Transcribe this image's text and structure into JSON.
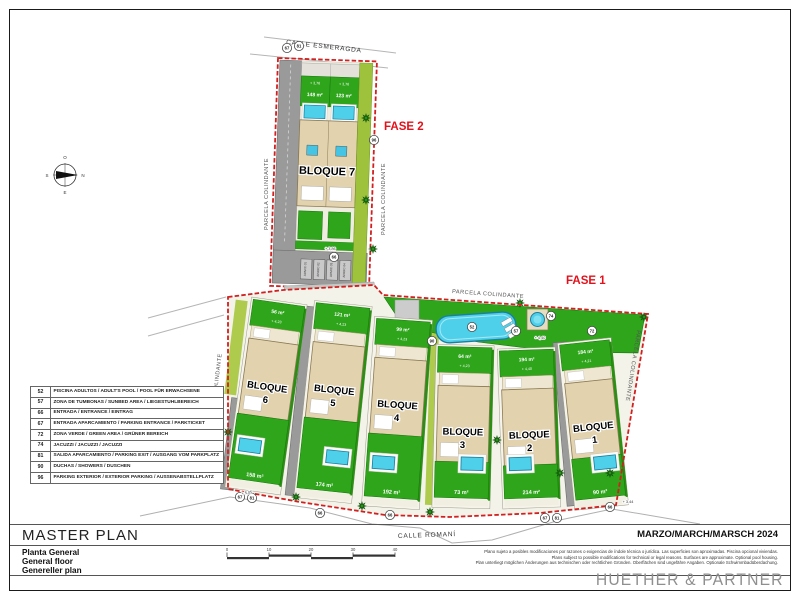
{
  "sheet": {
    "title": "MASTER PLAN",
    "subtitles": [
      "Planta General",
      "General floor",
      "Genereller plan"
    ],
    "date": "MARZO/MARCH/MARSCH 2024",
    "firm": "HUETHER & PARTNER",
    "disclaimer": [
      "Plano sujeto a posibles modificaciones por razones o exigencias de índole técnica o jurídica. Las superficies son aproximadas. Piscina opcional viviendas.",
      "Plans subject to possible modifications for technical or legal reasons. Surfaces are approximate. Optional pool housing.",
      "Plan unterliegt möglichen Änderungen aus technischen oder rechtlichen Gründen. Oberflächen sind ungefähre Angaben. Optionale Schwimmbadüberdachung."
    ],
    "scale_ticks": [
      "0",
      "10",
      "20",
      "30",
      "40"
    ]
  },
  "streets": {
    "top": "CALLE ESMERAGDA",
    "bottom": "CALLE ROMANÍ"
  },
  "phases": {
    "fase1": "FASE 1",
    "fase2": "FASE 2"
  },
  "labels": {
    "parcela_colindante": "PARCELA COLINDANTE"
  },
  "compass": {
    "top": "O",
    "right": "N",
    "bottom": "E",
    "left": "S"
  },
  "fase2_block": {
    "name": "BLOQUE 7",
    "garden_areas": [
      "148 m²",
      "123 m²"
    ],
    "garden_levels": [
      "+ 3,76",
      "+ 3,76"
    ],
    "parking_level": "+ 3,86",
    "stalls": [
      "APARC 01",
      "APARC 02",
      "APARC 03",
      "APARC 04"
    ]
  },
  "blocks": [
    {
      "label": "BLOQUE",
      "number": "6",
      "front_area": "56 m²",
      "level": "+ 4,23",
      "rear_area": "158 m²"
    },
    {
      "label": "BLOQUE",
      "number": "5",
      "front_area": "121 m²",
      "level": "+ 4,23",
      "rear_area": "174 m²"
    },
    {
      "label": "BLOQUE",
      "number": "4",
      "front_area": "99 m²",
      "level": "+ 4,23",
      "rear_area": "192 m²"
    },
    {
      "label": "BLOQUE",
      "number": "3",
      "front_area": "64 m²",
      "level": "+ 4,23",
      "rear_area": "73 m²"
    },
    {
      "label": "BLOQUE",
      "number": "2",
      "front_area": "194 m²",
      "level": "+ 4,40",
      "rear_area": "214 m²"
    },
    {
      "label": "BLOQUE",
      "number": "1",
      "front_area": "184 m²",
      "level": "+ 4,21",
      "rear_area": "90 m²"
    }
  ],
  "levels_misc": [
    "+ 4,40",
    "+ 3,44",
    "+ 5,05"
  ],
  "legend": {
    "rows": [
      {
        "code": "52",
        "desc": "PISCINA ADULTOS / ADULT'S POOL / POOL FÜR ERWACHSENE"
      },
      {
        "code": "57",
        "desc": "ZONA DE TUMBONAS / SUNBED AREA / LIEGESTUHLBEREICH"
      },
      {
        "code": "66",
        "desc": "ENTRADA / ENTRANCE / EINTRAG"
      },
      {
        "code": "67",
        "desc": "ENTRADA APARCAMIENTO / PARKING ENTRANCE / PARKTICKET"
      },
      {
        "code": "72",
        "desc": "ZONA VERDE / GREEN AREA / GRÜNER BEREICH"
      },
      {
        "code": "74",
        "desc": "JACUZZI / JACUZZI / JACUZZI"
      },
      {
        "code": "81",
        "desc": "SALIDA APARCAMIENTO / PARKING EXIT / AUSGANG VOM PARKPLATZ"
      },
      {
        "code": "90",
        "desc": "DUCHAS / SHOWERS / DUSCHEN"
      },
      {
        "code": "96",
        "desc": "PARKING EXTERIOR / EXTERIOR PARKING / AUSSENABSTELLPLATZ"
      }
    ]
  },
  "markers": [
    "67",
    "81",
    "96",
    "66",
    "52",
    "90",
    "57",
    "74",
    "72",
    "67",
    "81",
    "66",
    "66",
    "67",
    "81",
    "66"
  ],
  "colors": {
    "boundary": "#d21f1f",
    "green": "#2fa51c",
    "building": "#e2d3ae",
    "pool": "#4fd0ea",
    "drive": "#9a9a9a",
    "accent_red": "#e3111b",
    "lime": "#aecb4e"
  }
}
